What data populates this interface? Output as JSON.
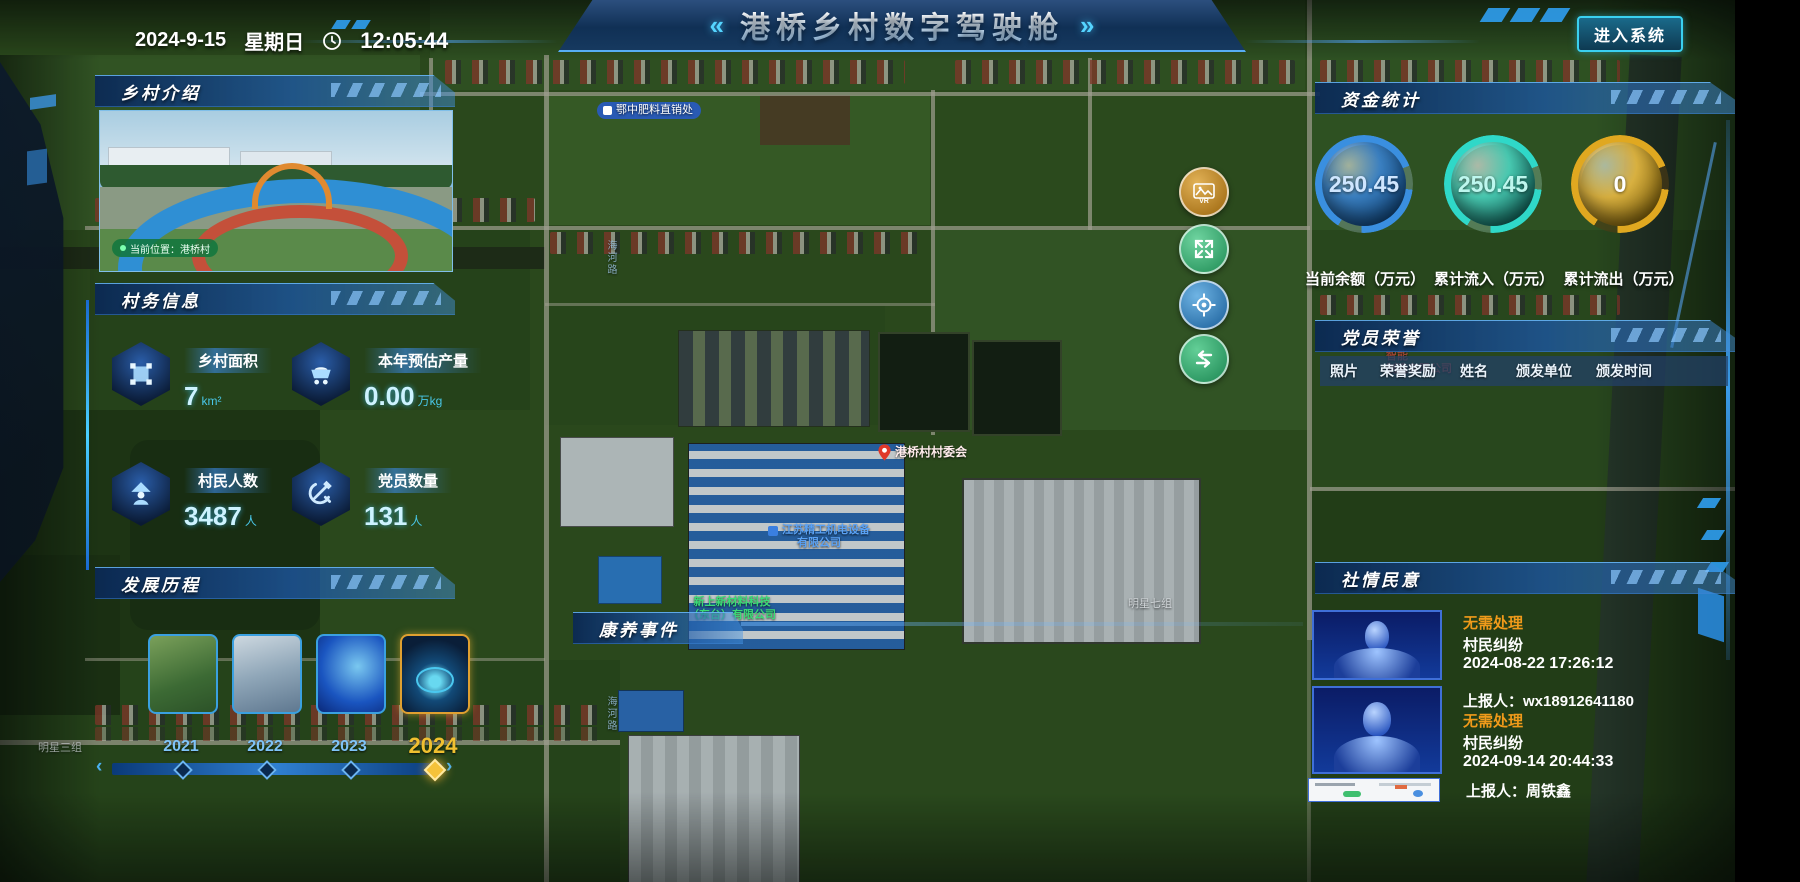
{
  "header": {
    "title": "港桥乡村数字驾驶舱",
    "left_chevron": "«",
    "right_chevron": "»",
    "date": "2024-9-15",
    "weekday": "星期日",
    "time": "12:05:44",
    "enter_button": "进入系统"
  },
  "panels": {
    "intro": {
      "title": "乡村介绍",
      "photo_caption": "当前位置：港桥村"
    },
    "affairs": {
      "title": "村务信息",
      "stats": [
        {
          "label": "乡村面积",
          "value": "7",
          "unit": "km²"
        },
        {
          "label": "本年预估产量",
          "value": "0.00",
          "unit": "万kg"
        },
        {
          "label": "村民人数",
          "value": "3487",
          "unit": "人"
        },
        {
          "label": "党员数量",
          "value": "131",
          "unit": "人"
        }
      ]
    },
    "development": {
      "title": "发展历程",
      "years": [
        "2021",
        "2022",
        "2023",
        "2024"
      ],
      "active_year": "2024"
    },
    "funds": {
      "title": "资金统计",
      "gauges": [
        {
          "value": "250.45",
          "label": "当前余额（万元）",
          "color": "#3a8fe0"
        },
        {
          "value": "250.45",
          "label": "累计流入（万元）",
          "color": "#2fd8c8"
        },
        {
          "value": "0",
          "label": "累计流出（万元）",
          "color": "#e0a820"
        }
      ]
    },
    "honor": {
      "title": "党员荣誉",
      "columns": [
        "照片",
        "荣誉奖励",
        "姓名",
        "颁发单位",
        "颁发时间"
      ]
    },
    "sentiment": {
      "title": "社情民意",
      "items": [
        {
          "status": "无需处理",
          "type": "村民纠纷",
          "time": "2024-08-22 17:26:12",
          "reporter": "上报人：wx18912641180"
        },
        {
          "status": "无需处理",
          "type": "村民纠纷",
          "time": "2024-09-14 20:44:33",
          "reporter": "上报人：周铁鑫"
        }
      ]
    },
    "health": {
      "title": "康养事件"
    }
  },
  "map": {
    "labels": {
      "poi_fertilizer": "鄂中肥料直销处",
      "committee": "港桥村村委会",
      "company1_line1": "江苏精工机电设备",
      "company1_line2": "有限公司",
      "company2_line1": "新上新材料科技",
      "company2_line2": "（东台）有限公司",
      "company3_line1": "智能",
      "company3_line2": "制造有限公司",
      "group7": "明星七组",
      "group3": "明星三组",
      "road": "海河路"
    }
  },
  "colors": {
    "accent": "#3ad0ff",
    "status_orange": "#f09a1a",
    "year_active": "#f0c030"
  }
}
